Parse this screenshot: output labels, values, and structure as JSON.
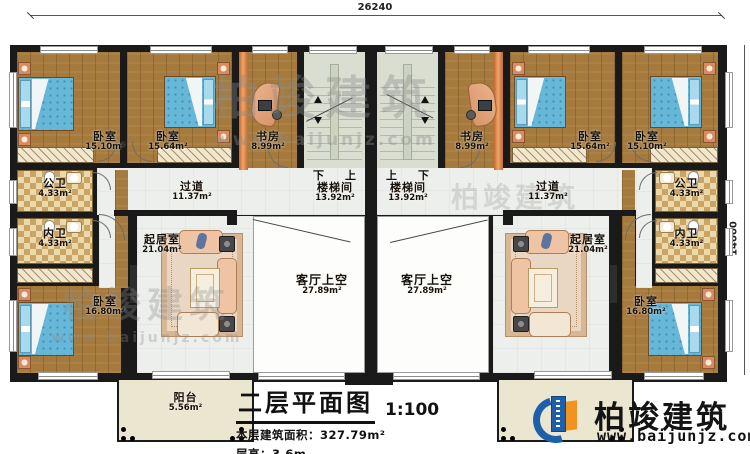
{
  "colors": {
    "wall": "#1a1a1a",
    "wood_floor": "#a57a3c",
    "bed_blue": "#67b7d9",
    "brand_blue": "#1d5fa8",
    "brand_orange": "#f0941f"
  },
  "dimensions": {
    "top_width": "26240",
    "right_height": "14000"
  },
  "title_block": {
    "title": "二层平面图",
    "scale": "1:100",
    "area_line": "本层建筑面积：327.79m²",
    "height_line": "层高：3.6m"
  },
  "brand": {
    "name": "柏竣建筑",
    "website": "www.baijunjz.com"
  },
  "watermark": {
    "text": "柏竣建筑",
    "url": "www.baijunjz.com"
  },
  "units": {
    "left": {
      "bedroom_a": {
        "label": "卧室",
        "area": "15.10m²"
      },
      "bedroom_b": {
        "label": "卧室",
        "area": "15.64m²"
      },
      "study": {
        "label": "书房",
        "area": "8.99m²"
      },
      "stairwell": {
        "label": "楼梯间",
        "area": "13.92m²",
        "dir_first": "下",
        "dir_second": "上"
      },
      "corridor": {
        "label": "过道",
        "area": "11.37m²"
      },
      "public_bath": {
        "label": "公卫",
        "area": "4.33m²"
      },
      "private_bath": {
        "label": "内卫",
        "area": "4.33m²"
      },
      "bedroom_c": {
        "label": "卧室",
        "area": "16.80m²"
      },
      "living": {
        "label": "起居室",
        "area": "21.04m²"
      },
      "void": {
        "label": "客厅上空",
        "area": "27.89m²"
      },
      "balcony": {
        "label": "阳台",
        "area": "5.56m²"
      }
    },
    "right": {
      "stairwell": {
        "label": "楼梯间",
        "area": "13.92m²",
        "dir_first": "上",
        "dir_second": "下"
      },
      "study": {
        "label": "书房",
        "area": "8.99m²"
      },
      "bedroom_b": {
        "label": "卧室",
        "area": "15.64m²"
      },
      "bedroom_a": {
        "label": "卧室",
        "area": "15.10m²"
      },
      "corridor": {
        "label": "过道",
        "area": "11.37m²"
      },
      "public_bath": {
        "label": "公卫",
        "area": "4.33m²"
      },
      "private_bath": {
        "label": "内卫",
        "area": "4.33m²"
      },
      "bedroom_c": {
        "label": "卧室",
        "area": "16.80m²"
      },
      "living": {
        "label": "起居室",
        "area": "21.04m²"
      },
      "void": {
        "label": "客厅上空",
        "area": "27.89m²"
      }
    }
  }
}
